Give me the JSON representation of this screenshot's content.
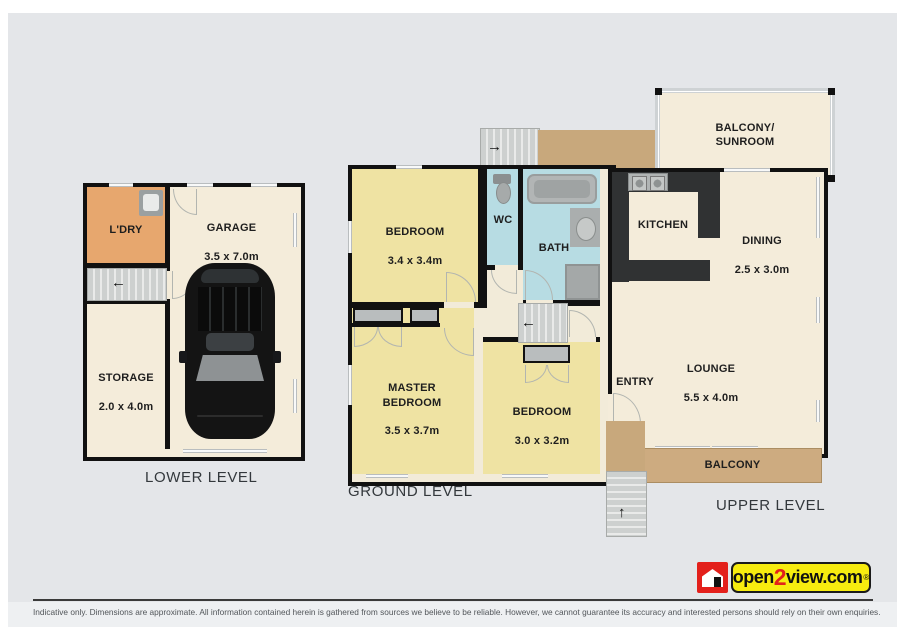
{
  "lower": {
    "caption": "LOWER LEVEL",
    "ldry": "L'DRY",
    "garage_name": "GARAGE",
    "garage_dims": "3.5 x 7.0m",
    "storage_name": "STORAGE",
    "storage_dims": "2.0 x 4.0m"
  },
  "ground": {
    "caption": "GROUND LEVEL",
    "bedroom1_name": "BEDROOM",
    "bedroom1_dims": "3.4 x 3.4m",
    "wc": "WC",
    "bath": "BATH",
    "master_name": "MASTER BEDROOM",
    "master_dims": "3.5 x 3.7m",
    "bedroom2_name": "BEDROOM",
    "bedroom2_dims": "3.0 x 3.2m"
  },
  "upper": {
    "caption": "UPPER LEVEL",
    "balcony_sunroom": "BALCONY/\nSUNROOM",
    "kitchen": "KITCHEN",
    "dining_name": "DINING",
    "dining_dims": "2.5 x 3.0m",
    "lounge_name": "LOUNGE",
    "lounge_dims": "5.5 x 4.0m",
    "entry": "ENTRY",
    "balcony": "BALCONY"
  },
  "icons": {
    "arrow_left": "←",
    "arrow_right": "→",
    "arrow_up": "↑"
  },
  "logo": {
    "open": "open",
    "two": "2",
    "view": "view.com",
    "reg": "®"
  },
  "footer": {
    "disclaimer": "Indicative only. Dimensions are approximate. All information contained herein is gathered from sources we believe to be reliable. However, we cannot guarantee its accuracy and interested persons should rely on their own enquiries."
  },
  "colors": {
    "wall": "#111111",
    "floor_cream": "#f4ecda",
    "room_yellow": "#efe3a3",
    "wet_area_blue": "#b7dce3",
    "deck_tan": "#c8a87c",
    "balcony_tan": "#cdab80",
    "laundry_orange": "#e7a76e",
    "counter_dark": "#303233",
    "logo_red": "#e3201b",
    "logo_yellow": "#f7ec0f"
  }
}
